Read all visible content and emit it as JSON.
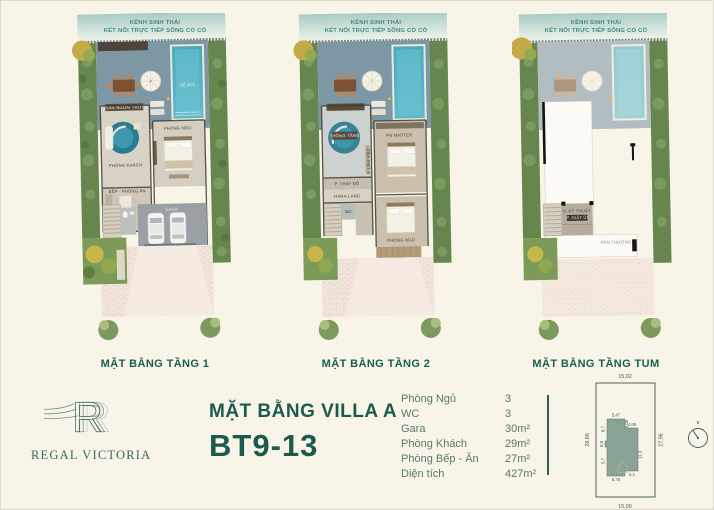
{
  "page": {
    "background": "#f8f4e8",
    "accent": "#1b5a4d"
  },
  "plans": [
    {
      "header1": "KÊNH SINH THÁI",
      "header2": "KẾT NỐI TRỰC TIẾP SÔNG CỔ CÒ",
      "label": "MẶT BẰNG TẦNG 1",
      "rooms": {
        "outdoor": "SÂN NGOÀI TRỜI",
        "pool": "BỂ BƠI",
        "living": "PHÒNG KHÁCH",
        "kitchen": "BẾP - PHÒNG ĂN",
        "bedroom": "PHÒNG NGỦ",
        "garage": "GARA"
      }
    },
    {
      "header1": "KÊNH SINH THÁI",
      "header2": "KẾT NỐI TRỰC TIẾP SÔNG CỔ CÒ",
      "label": "MẶT BẰNG TẦNG 2",
      "rooms": {
        "void": "THÔNG TẦNG",
        "master": "PN MASTER",
        "study": "P. LÀM VIỆC",
        "dressing": "P. THAY ĐỒ",
        "hallway": "HÀNH LANG",
        "wc": "WC",
        "bedroom": "PHÒNG NGỦ"
      }
    },
    {
      "header1": "KÊNH SINH THÁI",
      "header2": "KẾT NỐI TRỰC TIẾP SÔNG CỔ CÒ",
      "label": "MẶT BẰNG TẦNG TUM",
      "rooms": {
        "tech": "P. KỸ THUẬT",
        "laundry": "P. GIẶT ỦI",
        "terrace": "SÂN THƯỢNG"
      }
    }
  ],
  "footer": {
    "logo_letter": "R",
    "brand": "REGAL VICTORIA",
    "title_line1": "MẶT BẰNG VILLA A",
    "title_line2": "BT9-13",
    "specs": [
      {
        "label": "Phòng Ngủ",
        "value": "3"
      },
      {
        "label": "WC",
        "value": "3"
      },
      {
        "label": "Gara",
        "value": "30m²"
      },
      {
        "label": "Phòng Khách",
        "value": "29m²"
      },
      {
        "label": "Phòng Bếp - Ăn",
        "value": "27m²"
      },
      {
        "label": "Diện tích",
        "value": "427m²"
      }
    ],
    "siteplan": {
      "dim_top": "15,02",
      "dim_bottom": "15,00",
      "dim_left": "28,66",
      "dim_right": "27,96",
      "d1": "5,47",
      "d2": "3,05",
      "d3": "4,69",
      "d4": "8,7",
      "d5": "0,6",
      "d6": "5,7",
      "d7": "5,76",
      "d8": "5,1",
      "d9": "11,3",
      "compass": "B"
    }
  }
}
